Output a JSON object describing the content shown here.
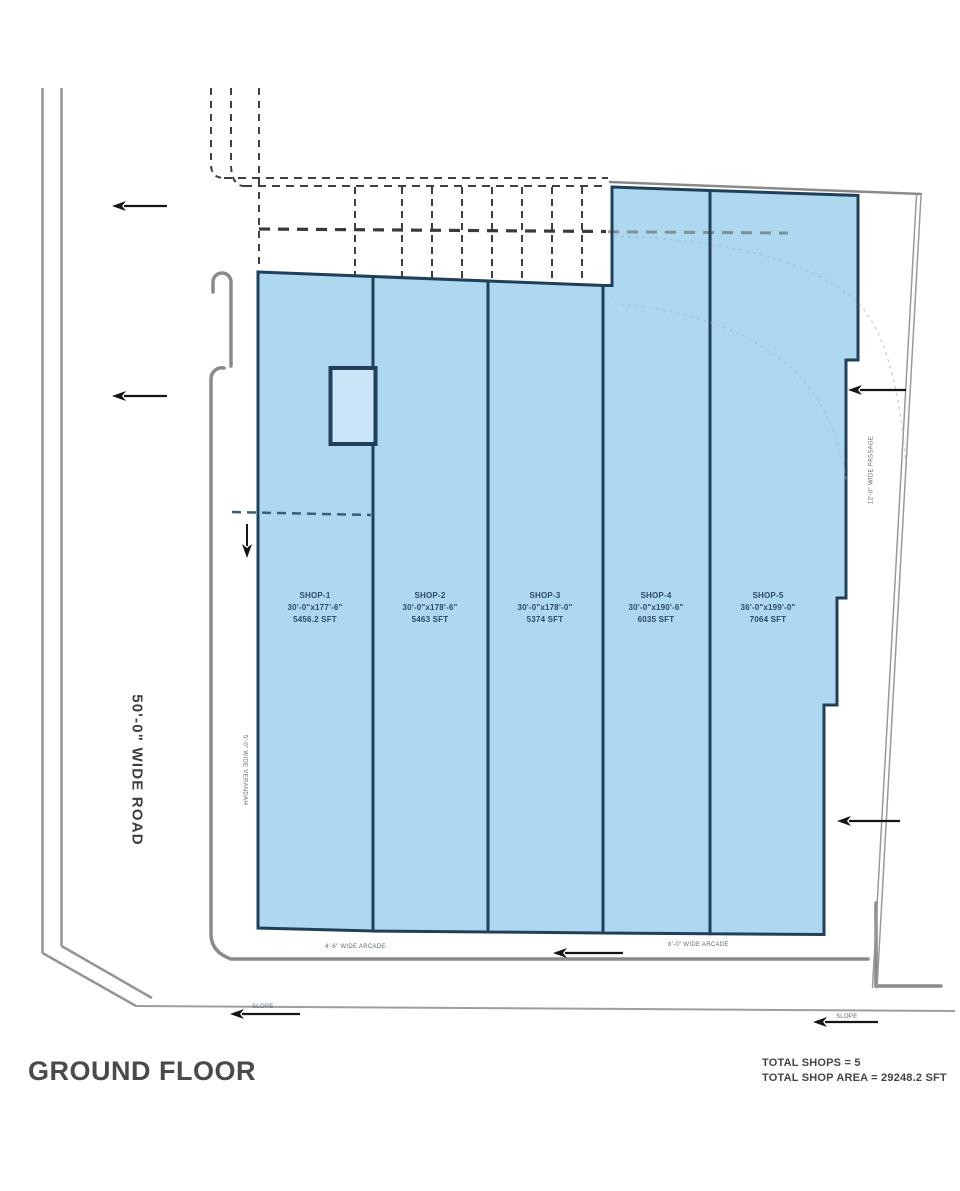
{
  "title": "GROUND FLOOR",
  "road_label": "50'-0\" WIDE ROAD",
  "summary": {
    "total_shops": "TOTAL SHOPS = 5",
    "total_area": "TOTAL SHOP AREA = 29248.2 SFT"
  },
  "shops": [
    {
      "name": "SHOP-1",
      "dimensions": "30'-0\"x177'-6\"",
      "area": "5456.2 SFT"
    },
    {
      "name": "SHOP-2",
      "dimensions": "30'-0\"x178'-6\"",
      "area": "5463 SFT"
    },
    {
      "name": "SHOP-3",
      "dimensions": "30'-0\"x178'-0\"",
      "area": "5374 SFT"
    },
    {
      "name": "SHOP-4",
      "dimensions": "30'-0\"x190'-6\"",
      "area": "6035 SFT"
    },
    {
      "name": "SHOP-5",
      "dimensions": "36'-0\"x199'-0\"",
      "area": "7064 SFT"
    }
  ],
  "annotations": {
    "arcade_left": "4'-6\" WIDE ARCADE",
    "arcade_right": "8'-0\" WIDE ARCADE",
    "verandah": "5'-0\" WIDE VERANDAH",
    "passage_right": "12'-0\" WIDE PASSAGE",
    "slope_left": "SLOPE",
    "slope_right": "SLOPE"
  },
  "colors": {
    "shop_fill": "#aed8f0",
    "stair_fill": "#c8e6f7",
    "shop_border": "#20405a",
    "boundary_gray": "#8a8a8a",
    "dashed_gray": "#3f3f3f",
    "arrow_black": "#151515",
    "shop_label_blue": "#2b4a68",
    "text_gray": "#4a4a4a"
  }
}
